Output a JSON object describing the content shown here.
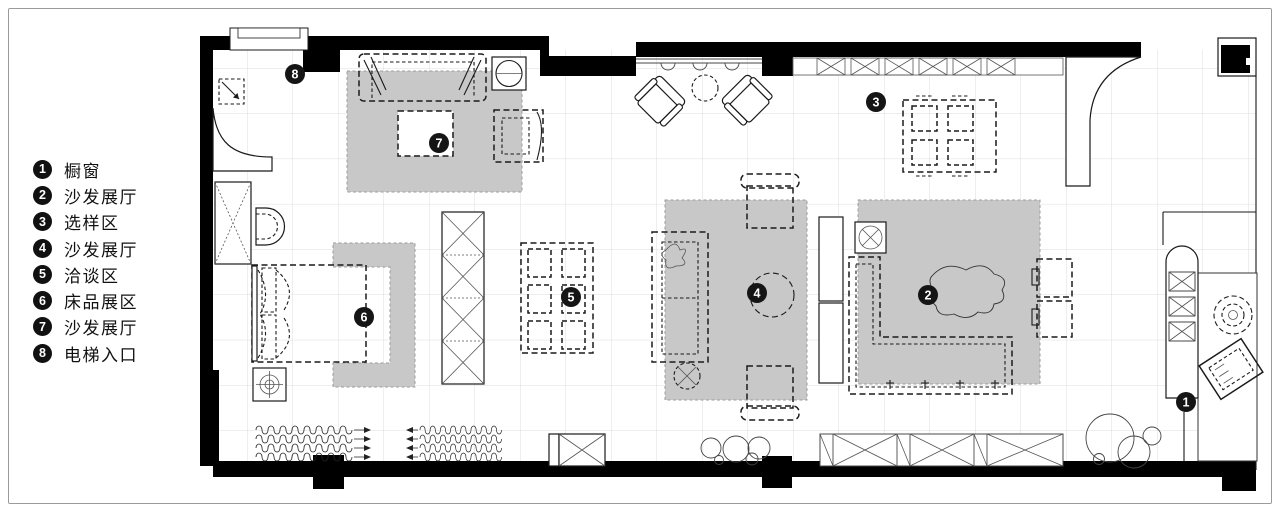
{
  "legend": {
    "items": [
      {
        "num": "1",
        "label": "橱窗"
      },
      {
        "num": "2",
        "label": "沙发展厅"
      },
      {
        "num": "3",
        "label": "选样区"
      },
      {
        "num": "4",
        "label": "沙发展厅"
      },
      {
        "num": "5",
        "label": "洽谈区"
      },
      {
        "num": "6",
        "label": "床品展区"
      },
      {
        "num": "7",
        "label": "沙发展厅"
      },
      {
        "num": "8",
        "label": "电梯入口"
      }
    ]
  },
  "plan": {
    "markers": [
      {
        "num": "1"
      },
      {
        "num": "2"
      },
      {
        "num": "3"
      },
      {
        "num": "4"
      },
      {
        "num": "5"
      },
      {
        "num": "6"
      },
      {
        "num": "7"
      },
      {
        "num": "8"
      }
    ],
    "colors": {
      "wall": "#000000",
      "carpet": "#c8c8c8",
      "grid": "#dedede",
      "frame_border": "#9a9a9a",
      "marker_bg": "#151515",
      "marker_text": "#ffffff"
    }
  }
}
